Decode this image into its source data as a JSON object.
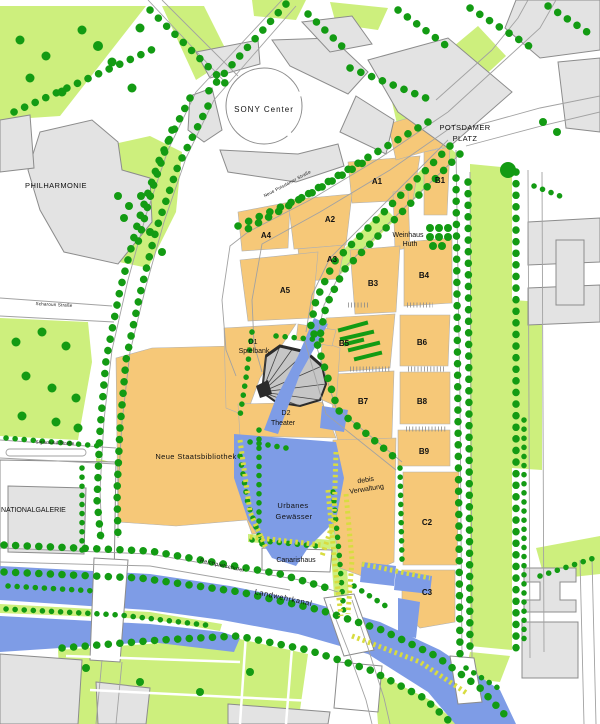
{
  "map": {
    "colors": {
      "background": "#ffffff",
      "planned_block": "#f6c878",
      "existing_building": "#e3e3e3",
      "building_outline": "#8c8c8c",
      "park_green": "#cdef7d",
      "tree_green": "#139b13",
      "water_blue": "#7e9ce6",
      "reed_yellow": "#d8dc40",
      "street_line": "#a2a2a2",
      "label_color": "#111111",
      "fan_dark": "#2b2b2b",
      "fan_fill": "#c6c6c6"
    },
    "labels": {
      "sony_center": "SONY Center",
      "potsdamer_platz_line1": "POTSDAMER",
      "potsdamer_platz_line2": "PLATZ",
      "philharmonie": "PHILHARMONIE",
      "nationalgalerie": "NATIONALGALERIE",
      "staatsbibliothek": "Neue Staatsbibliothek",
      "weinhaus_line1": "Weinhaus",
      "weinhaus_line2": "Huth",
      "d1_line1": "D1",
      "d1_line2": "Spielbank",
      "d2_line1": "D2",
      "d2_line2": "Theater",
      "debis_line1": "debis",
      "debis_line2": "Verwaltung",
      "urbanes_line1": "Urbanes",
      "urbanes_line2": "Gewässer",
      "canarishaus": "Canarishaus",
      "landwehrkanal": "Landwehrkanal",
      "reichpietschufer": "Reichpietschufer",
      "strasse_neue_potsdamer": "Neue Potsdamer Straße",
      "strasse_scharoun": "Scharoun Straße",
      "strasse_sigismund": "Sigismund Straße"
    },
    "blocks": [
      {
        "label": "A1"
      },
      {
        "label": "A2"
      },
      {
        "label": "A3"
      },
      {
        "label": "A4"
      },
      {
        "label": "A5"
      },
      {
        "label": "B1"
      },
      {
        "label": "B3"
      },
      {
        "label": "B4"
      },
      {
        "label": "B5"
      },
      {
        "label": "B6"
      },
      {
        "label": "B7"
      },
      {
        "label": "B8"
      },
      {
        "label": "B9"
      },
      {
        "label": "C2"
      },
      {
        "label": "C3"
      }
    ]
  }
}
